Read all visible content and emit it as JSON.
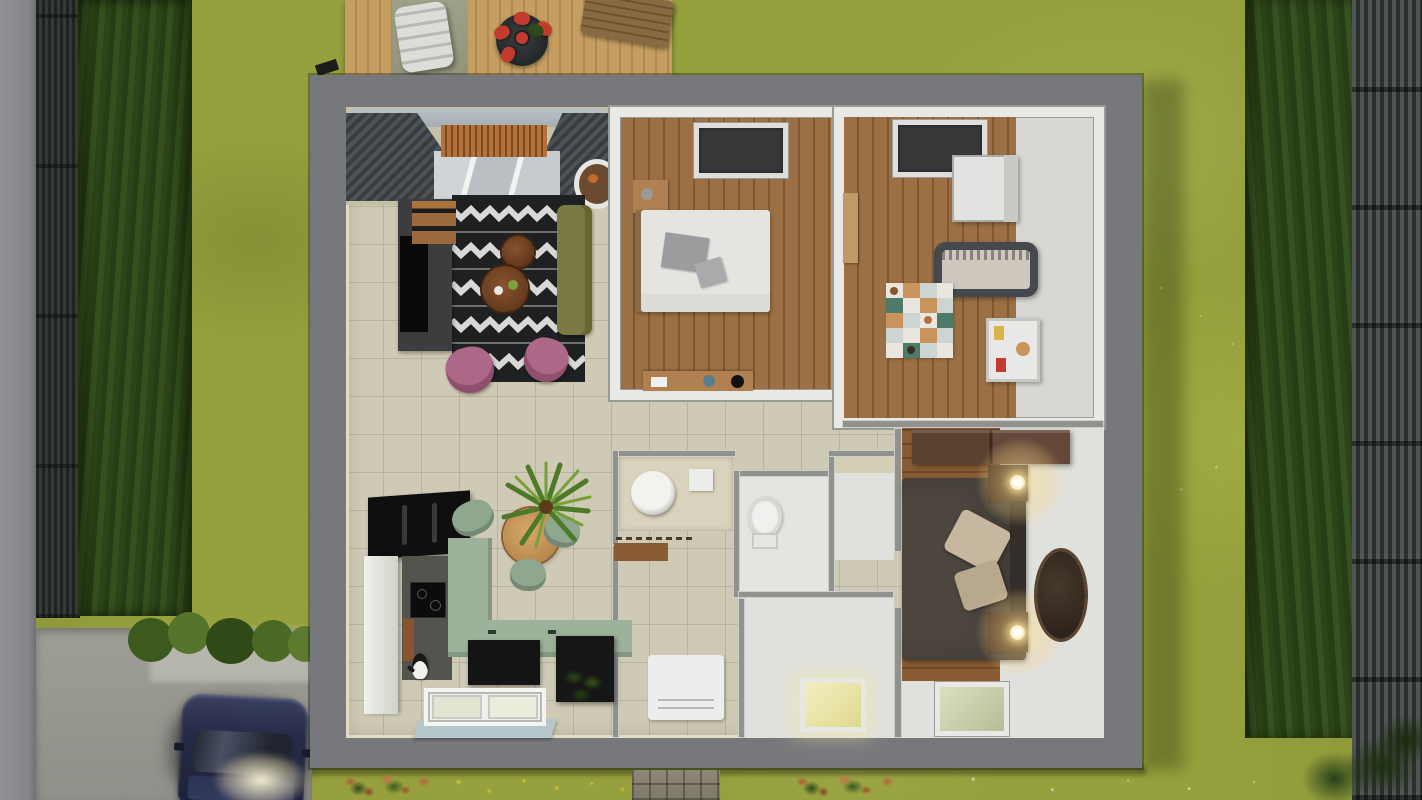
{
  "meta": {
    "description": "Top-down 3D architectural render of a single-storey house interior (roof removed) in a fenced garden, dusk lighting, lamps lit",
    "view": "overhead cutaway floor plan render"
  },
  "palette": {
    "lawn": "#96a03c",
    "road": "#8f9193",
    "gravel": "#9e9e96",
    "fenceDark": "#24292b",
    "hedge": "#2f4519",
    "wallGray": "#77787b",
    "innerWall": "#91918d",
    "wallLip": "#e2dcc4",
    "tile": "#cfcab5",
    "white": "#e9e9e6",
    "floorWhite": "#e0e0dc",
    "deck": "#c59f62",
    "rugBlack": "#1f2022",
    "rugWhite": "#dcdcda",
    "sofa": "#7b7a45",
    "pink": "#ad6787",
    "tableWood": "#7a4a28",
    "sage": "#9db29a",
    "sageChair": "#8fa68f",
    "applianceBlack": "#111214",
    "plantGreen": "#4d7a27",
    "plantLight": "#76a038",
    "duvetDark": "#4c463f",
    "pillowBeige": "#c6b79e",
    "ovalRug": "#38302a",
    "crib": "#45484c",
    "matCream": "#e8e6de",
    "matTeal": "#4e7a68",
    "matTan": "#c9935c",
    "matGray": "#cdd5d2",
    "skylightGlow": "#efe9b2",
    "lampGlow": "#ffd98f",
    "carBody": "#2a2f4c",
    "red": "#c23b2e",
    "rust": "#b05a3a",
    "windowSill": "#b7c6cb",
    "slatGray": "#4c5256",
    "woodScreen": "#b5713a",
    "glass": "#c3cacc"
  },
  "scene": {
    "outdoor": {
      "left_boundary": [
        "sidewalk",
        "dark-slat-fence",
        "tall-hedge"
      ],
      "right_boundary": [
        "hedge",
        "slat-fence"
      ],
      "deck": {
        "name": "wooden terrace",
        "items": [
          "stone-path",
          "sun-lounger",
          "round-dining-table",
          "red-chairs",
          "wooden-bench"
        ]
      },
      "driveway": {
        "name": "gravel driveway",
        "items": [
          "shrub-row",
          "navy-car-headlights-on"
        ]
      },
      "garden_strip": [
        "rust-flower-bush",
        "yellow-flowers",
        "paved-tile-path",
        "rust-flower-bush",
        "corner-shrub"
      ]
    },
    "house": {
      "walls": "thick gray exterior walls, roofless top-down cutaway",
      "rooms": [
        {
          "id": "living-room",
          "name": "Living room",
          "items": [
            "louvered-canopy",
            "glass-canopy",
            "wood-slat-screen",
            "hanging-chair",
            "zigzag-rug",
            "olive-sofa",
            "coffee-table-small",
            "coffee-table-large",
            "pink-armchair-left",
            "pink-armchair-right",
            "tv-sideboard",
            "tv",
            "wood-cabinet"
          ]
        },
        {
          "id": "bedroom",
          "name": "Bedroom",
          "items": [
            "skylight",
            "double-bed-white",
            "gray-pillows",
            "nightstand",
            "desk"
          ]
        },
        {
          "id": "nursery",
          "name": "Nursery",
          "items": [
            "skylight",
            "white-wardrobe",
            "crib",
            "patchwork-playmat",
            "toy-shelf",
            "wall-shelf"
          ]
        },
        {
          "id": "kitchen-dining",
          "name": "Kitchen / dining",
          "items": [
            "black-wall-cabinets",
            "tall-white-cabinet",
            "induction-hob",
            "cutting-board",
            "sage-counter-L",
            "black-base-units",
            "black-island",
            "potted-plant-dark",
            "dining-table-round",
            "palm-plant",
            "sage-chairs",
            "kitchen-window",
            "cat"
          ]
        },
        {
          "id": "laundry",
          "name": "Laundry nook",
          "items": [
            "counter",
            "washing-machine",
            "detergent-box",
            "wall-rail",
            "wood-shelf"
          ]
        },
        {
          "id": "wc",
          "name": "WC",
          "items": [
            "toilet"
          ]
        },
        {
          "id": "bathroom-hall",
          "name": "Bathroom hall",
          "items": [
            "pedestal-sink",
            "glowing-skylight"
          ]
        },
        {
          "id": "entry",
          "name": "Entry hall",
          "items": [
            "white-doormat"
          ]
        },
        {
          "id": "closet",
          "name": "Closet",
          "items": [
            "shelf-band"
          ]
        },
        {
          "id": "master-bedroom",
          "name": "Master bedroom",
          "items": [
            "dark-wardrobe",
            "double-bed-dark-duvet",
            "beige-pillows",
            "headboard",
            "nightstand-top",
            "nightstand-bottom",
            "lit-lamp-top",
            "lit-lamp-bottom",
            "oval-rug",
            "skylight"
          ]
        }
      ]
    }
  }
}
